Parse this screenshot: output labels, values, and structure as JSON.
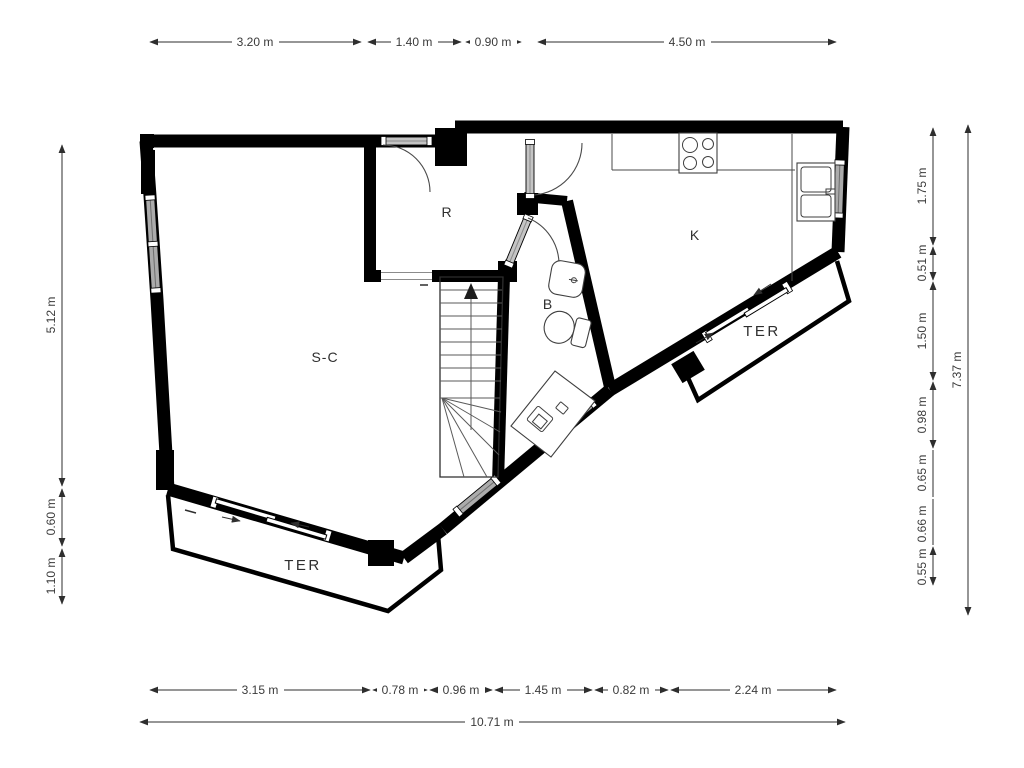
{
  "plan": {
    "title": "apartment-floor-plan",
    "rooms": {
      "living": "S-C",
      "bedroom": "R",
      "kitchen": "K",
      "bathroom": "B",
      "terrace_left": "TER",
      "terrace_right": "TER"
    },
    "dims": {
      "top": [
        "3.20 m",
        "1.40 m",
        "0.90 m",
        "4.50 m"
      ],
      "bottom": [
        "3.15 m",
        "0.78 m",
        "0.96 m",
        "1.45 m",
        "0.82 m",
        "2.24 m"
      ],
      "bottom_total": "10.71 m",
      "left": [
        "5.12 m",
        "0.60 m",
        "1.10 m"
      ],
      "right": [
        "1.75 m",
        "0.51 m",
        "1.50 m",
        "0.98 m",
        "0.65 m",
        "0.66 m",
        "0.55 m"
      ],
      "right_total": "7.37 m"
    },
    "colors": {
      "wall": "#000000",
      "dimension_text": "#3a3a3a",
      "window_fill": "#ababab",
      "background": "#ffffff"
    }
  }
}
